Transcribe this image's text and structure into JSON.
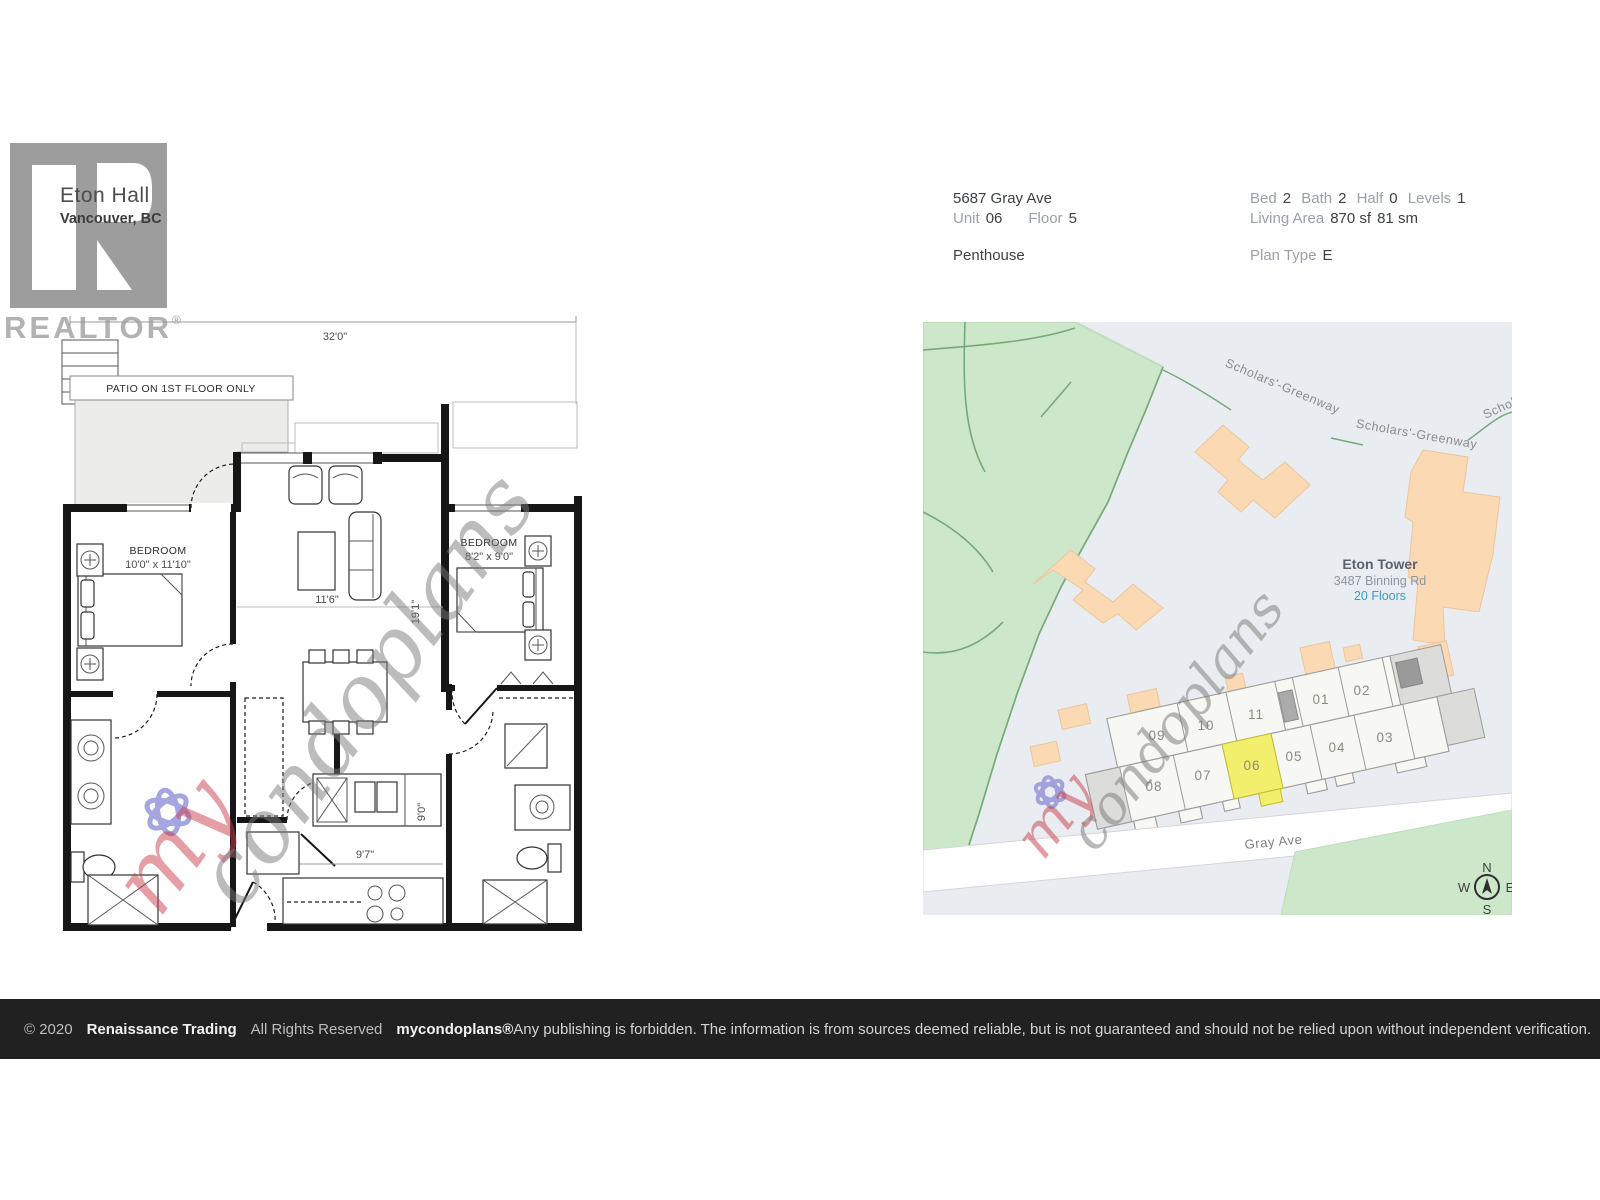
{
  "brand": {
    "logo": "realtor-logo",
    "logo_word": "REALTOR",
    "logo_reg": "®",
    "building_name": "Eton Hall",
    "city": "Vancouver, BC"
  },
  "details": {
    "address": "5687 Gray Ave",
    "unit_label": "Unit",
    "unit_value": "06",
    "floor_label": "Floor",
    "floor_value": "5",
    "type": "Penthouse",
    "bed_label": "Bed",
    "bed": "2",
    "bath_label": "Bath",
    "bath": "2",
    "half_label": "Half",
    "half": "0",
    "levels_label": "Levels",
    "levels": "1",
    "living_area_label": "Living Area",
    "living_area_sf": "870 sf",
    "living_area_sm": "81 sm",
    "plan_type_label": "Plan Type",
    "plan_type": "E"
  },
  "floor_plan": {
    "overall_width": "32'0\"",
    "patio_note": "PATIO ON 1ST FLOOR ONLY",
    "bedroom1_name": "BEDROOM",
    "bedroom1_dims": "10'0\" x 11'10\"",
    "bedroom2_name": "BEDROOM",
    "bedroom2_dims": "8'2\" x 9'0\"",
    "living_width": "11'6\"",
    "living_height": "19'1\"",
    "kitchen_width": "9'7\"",
    "kitchen_height": "9'0\""
  },
  "watermark": {
    "prefix": "my",
    "suffix": "condoplans"
  },
  "map": {
    "street_main": "Gray Ave",
    "greenway1": "Scholars'-Greenway",
    "greenway2": "Scholars'-Greenway",
    "greenway_partial": "Schol",
    "tower_name": "Eton Tower",
    "tower_address": "3487 Binning Rd",
    "tower_floors": "20 Floors",
    "units": [
      "01",
      "02",
      "03",
      "04",
      "05",
      "06",
      "07",
      "08",
      "09",
      "10",
      "11"
    ],
    "highlighted_unit": "06",
    "compass": {
      "n": "N",
      "e": "E",
      "s": "S",
      "w": "W"
    },
    "colors": {
      "park": "#cde7ca",
      "building": "#fbd9b2",
      "highlight": "#f2ef6d",
      "bg": "#e9edf1"
    }
  },
  "footer": {
    "copyright": "© 2020",
    "company": "Renaissance Trading",
    "rights": "All Rights Reserved",
    "brand": "mycondoplans®",
    "disclaimer": "Any publishing is forbidden.  The information is from sources deemed reliable, but is not guaranteed and should not be relied upon without independent verification."
  }
}
